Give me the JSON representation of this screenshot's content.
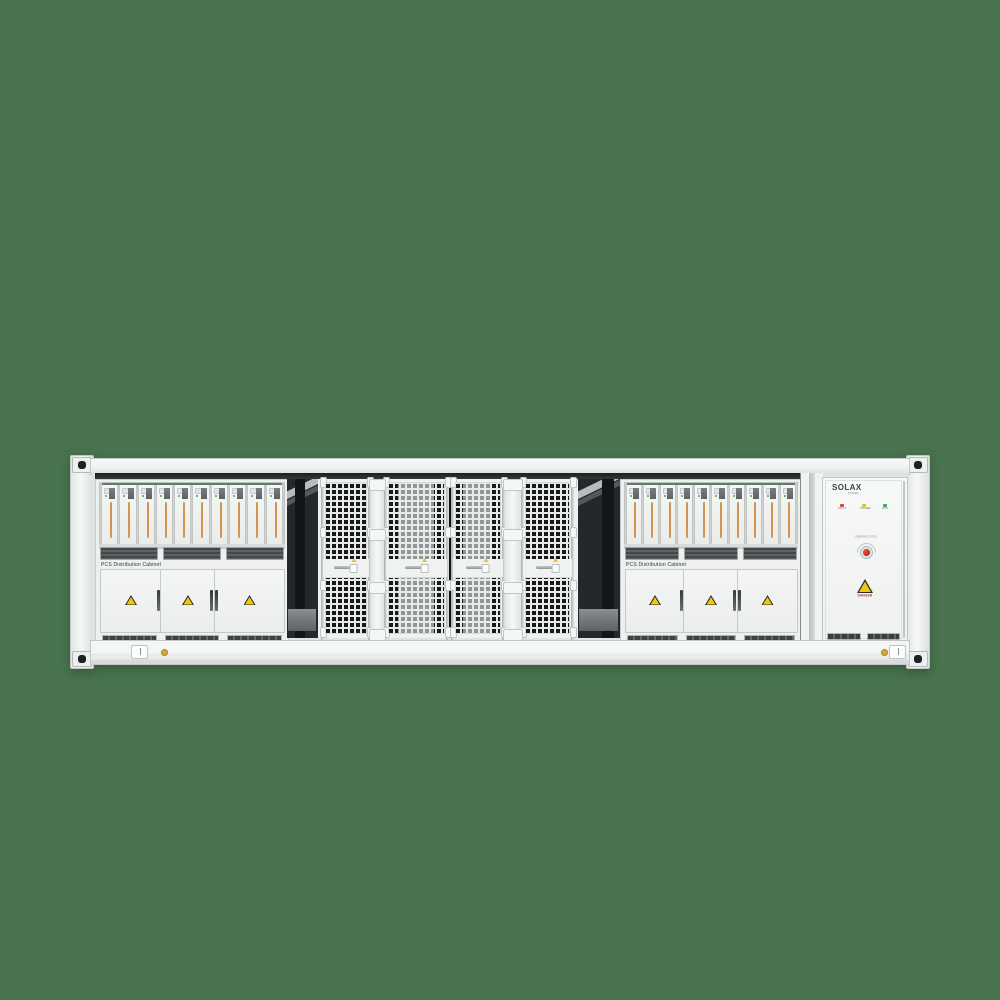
{
  "scene": {
    "background_color": "#48734E"
  },
  "pcs_cabinet_left": {
    "label": "PCS Distribution Cabinet",
    "module_count": 10,
    "door_count": 3,
    "stripe_color": "#D2954F"
  },
  "pcs_cabinet_right": {
    "label": "PCS Distribution Cabinet",
    "module_count": 10,
    "door_count": 3,
    "stripe_color": "#D2954F"
  },
  "battery_bay": {
    "door_count": 4
  },
  "control_cabinet": {
    "brand": "SOLAX",
    "brand_sub": "POWER",
    "leds": [
      {
        "label": "FAULT",
        "color": "#D9442F"
      },
      {
        "label": "POWER",
        "color": "#E3BE16"
      },
      {
        "label": "RUN",
        "color": "#3FA84C"
      }
    ],
    "estop_label": "EMERGENCY STOP",
    "warning_label": "DANGER"
  }
}
